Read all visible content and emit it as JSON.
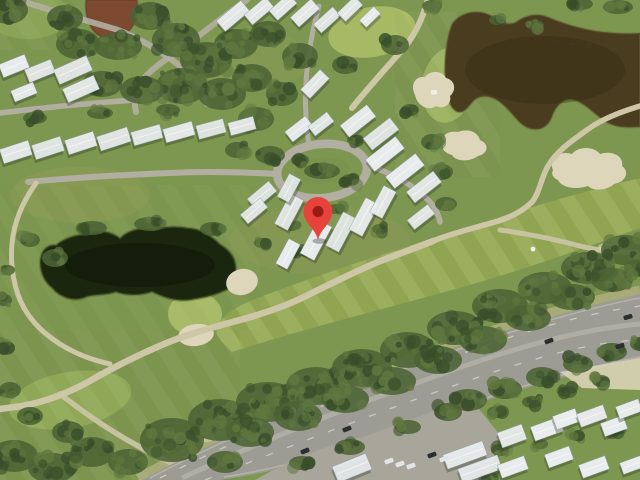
{
  "map": {
    "view_label": "satellite-imagery",
    "watermark": {
      "text": "© 2025 Go"
    },
    "marker": {
      "x": 318,
      "y": 240,
      "label": "dropped-pin"
    },
    "golf_markers": {
      "flag": {
        "x": 533,
        "y": 249
      },
      "cart": {
        "x": 434,
        "y": 92
      }
    },
    "palette": {
      "base_green": "#7e9750",
      "fairway_green": "#96aa55",
      "putting_green": "#a6ba66",
      "rough_green": "#6f8847",
      "tree_dark": "#384e2a",
      "tree_mid": "#4c6334",
      "tree_light": "#60783f",
      "pond_brown": "#4a3c1e",
      "pond_dark": "#1b260e",
      "pond_red": "#7d4a31",
      "sand": "#ddd6ba",
      "path_tan": "#cdc7a8",
      "road_gray": "#b2afa2",
      "highway_gray": "#9c9c94",
      "highway_light": "#b1b0a6",
      "shoulder_sand": "#c7bb98",
      "roof_white": "#e9edee",
      "roof_shadow": "#233018",
      "car_dark": "#2c2f30",
      "car_light": "#e2e5e5",
      "pin_red": "#e8433a",
      "pin_dot": "#991b13",
      "watermark": "rgba(70,64,42,0.55)"
    },
    "houses": [
      [
        14,
        66,
        28,
        14,
        -22
      ],
      [
        40,
        71,
        28,
        14,
        -22
      ],
      [
        73,
        70,
        36,
        16,
        -24
      ],
      [
        81,
        89,
        34,
        15,
        -24
      ],
      [
        24,
        92,
        24,
        12,
        -22
      ],
      [
        16,
        152,
        30,
        15,
        -18
      ],
      [
        48,
        148,
        30,
        15,
        -18
      ],
      [
        81,
        143,
        30,
        15,
        -18
      ],
      [
        114,
        139,
        32,
        15,
        -18
      ],
      [
        147,
        135,
        30,
        14,
        -16
      ],
      [
        179,
        132,
        30,
        14,
        -16
      ],
      [
        211,
        129,
        28,
        14,
        -15
      ],
      [
        242,
        126,
        26,
        13,
        -15
      ],
      [
        233,
        16,
        32,
        14,
        -40
      ],
      [
        259,
        11,
        28,
        13,
        -40
      ],
      [
        283,
        7,
        26,
        13,
        -42
      ],
      [
        305,
        13,
        28,
        13,
        -42
      ],
      [
        327,
        20,
        26,
        12,
        -42
      ],
      [
        350,
        9,
        24,
        12,
        -44
      ],
      [
        370,
        17,
        20,
        10,
        -44
      ],
      [
        315,
        84,
        28,
        13,
        -46
      ],
      [
        299,
        129,
        26,
        13,
        -38
      ],
      [
        321,
        124,
        24,
        12,
        -38
      ],
      [
        262,
        195,
        28,
        13,
        -40
      ],
      [
        254,
        211,
        26,
        12,
        -40
      ],
      [
        358,
        121,
        34,
        15,
        -38
      ],
      [
        381,
        134,
        34,
        15,
        -38
      ],
      [
        385,
        154,
        38,
        15,
        -38
      ],
      [
        405,
        171,
        38,
        15,
        -38
      ],
      [
        424,
        187,
        34,
        14,
        -38
      ],
      [
        421,
        217,
        26,
        12,
        -38
      ],
      [
        289,
        212,
        34,
        15,
        -62
      ],
      [
        316,
        240,
        38,
        16,
        -62
      ],
      [
        341,
        232,
        38,
        15,
        -62
      ],
      [
        364,
        217,
        36,
        15,
        -62
      ],
      [
        383,
        202,
        30,
        14,
        -62
      ],
      [
        289,
        188,
        26,
        13,
        -62
      ],
      [
        288,
        254,
        28,
        13,
        -62
      ],
      [
        465,
        455,
        42,
        15,
        -20
      ],
      [
        480,
        469,
        42,
        15,
        -20
      ],
      [
        512,
        436,
        26,
        16,
        -20
      ],
      [
        547,
        429,
        30,
        15,
        -20
      ],
      [
        566,
        419,
        24,
        14,
        -20
      ],
      [
        592,
        416,
        28,
        14,
        -20
      ],
      [
        614,
        426,
        24,
        14,
        -20
      ],
      [
        629,
        409,
        24,
        13,
        -20
      ],
      [
        513,
        467,
        28,
        14,
        -20
      ],
      [
        559,
        457,
        26,
        14,
        -20
      ],
      [
        594,
        467,
        28,
        14,
        -20
      ],
      [
        632,
        465,
        22,
        12,
        -20
      ],
      [
        352,
        468,
        36,
        17,
        -22
      ]
    ],
    "cars": [
      [
        549,
        341,
        -20,
        "dark"
      ],
      [
        620,
        346,
        -16,
        "dark"
      ],
      [
        628,
        317,
        -16,
        "dark"
      ],
      [
        347,
        429,
        -22,
        "dark"
      ],
      [
        305,
        451,
        -22,
        "dark"
      ],
      [
        389,
        461,
        -20,
        "light"
      ],
      [
        400,
        464,
        -20,
        "light"
      ],
      [
        411,
        466,
        -20,
        "light"
      ],
      [
        432,
        455,
        -20,
        "dark"
      ],
      [
        444,
        459,
        -20,
        "light"
      ]
    ]
  }
}
